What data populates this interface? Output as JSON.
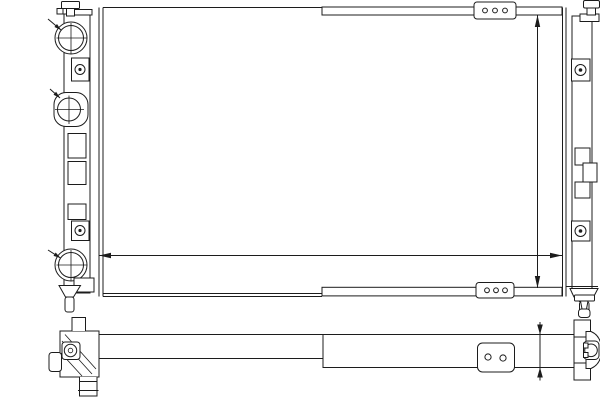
{
  "watermark": {
    "logo": "S",
    "brand": "STELLOX",
    "color": "#dcdcdc"
  },
  "colors": {
    "line": "#1c1c1c",
    "background": "#ffffff",
    "watermark": "#dcdcdc"
  },
  "dimensions": {
    "inlet_diameter": "Ø32",
    "thread_spec": "M22x1,5",
    "outlet_diameter": "Ø32",
    "core_width": "620",
    "core_height": "322",
    "core_depth": "32"
  }
}
